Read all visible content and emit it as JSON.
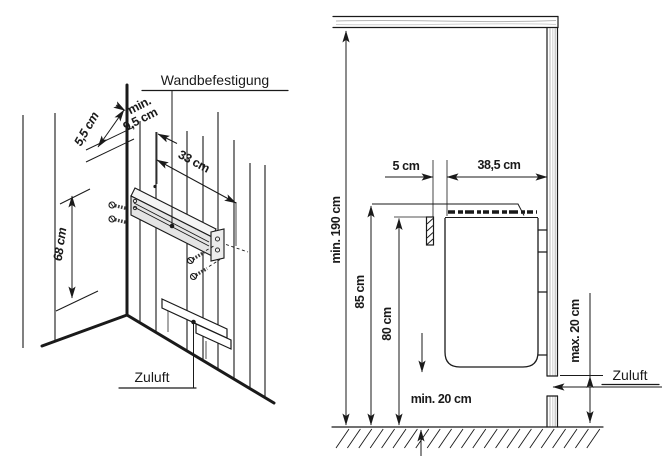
{
  "figure": {
    "left_panel": {
      "title_label": "Wandbefestigung",
      "air_supply_label": "Zuluft",
      "dims": {
        "corner_offset": "5,5 cm",
        "min_clearance_prefix": "min.",
        "min_clearance_value": "9,5 cm",
        "bracket_width": "33 cm",
        "bracket_height": "68 cm"
      }
    },
    "right_panel": {
      "air_supply_label": "Zuluft",
      "dims": {
        "min_ceiling_height": "min. 190 cm",
        "top_edge_height": "85 cm",
        "bracket_mount_height": "80 cm",
        "wall_gap": "5 cm",
        "heater_depth": "38,5 cm",
        "min_floor_clearance": "min. 20 cm",
        "max_inlet_height": "max. 20 cm"
      }
    },
    "colors": {
      "line": "#1a1a1a",
      "bracket_fill": "#e4e4e4",
      "grain": "#b4b4b4"
    }
  }
}
